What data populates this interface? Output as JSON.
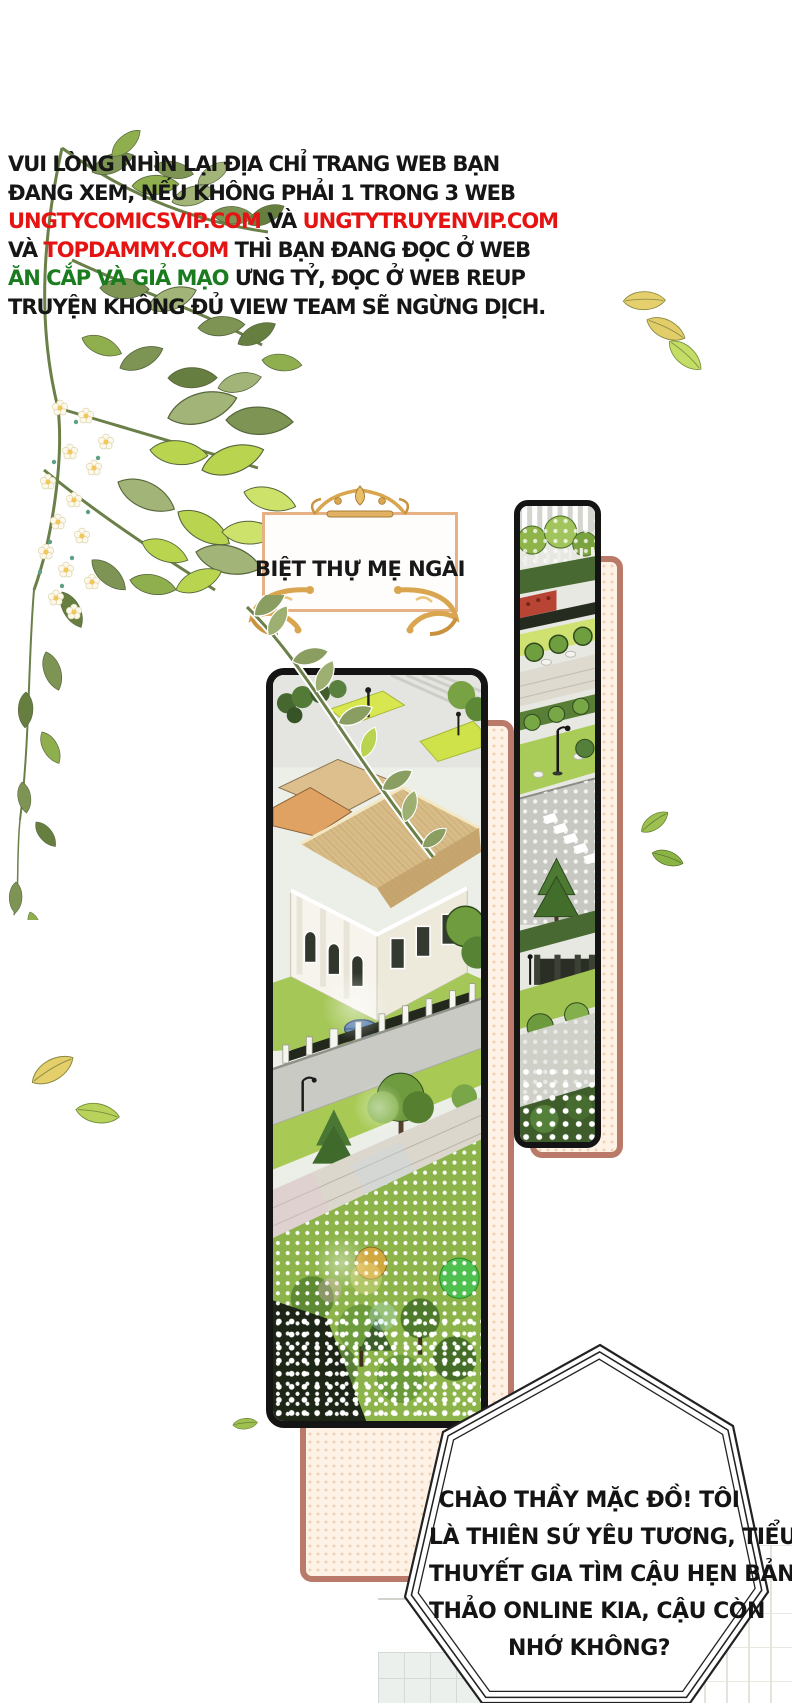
{
  "page": {
    "width": 792,
    "height": 1703,
    "background": "#ffffff",
    "kind": "comic-page"
  },
  "warning": {
    "line1": "VUI LÒNG NHÌN LẠI ĐỊA CHỈ TRANG WEB BẠN",
    "line2": "ĐANG XEM, NẾU KHÔNG PHẢI 1 TRONG 3 WEB",
    "line3_url1": "UNGTYCOMICSVIP.COM",
    "line3_mid": " VÀ ",
    "line3_url2": "UNGTYTRUYENVIP.COM",
    "line4_pre": "VÀ ",
    "line4_url3": "TOPDAMMY.COM",
    "line4_post": " THÌ BẠN ĐANG ĐỌC Ở WEB",
    "line5_green": "ĂN CẮP VÀ GIẢ MẠO",
    "line5_post": " ƯNG TỶ, ĐỌC Ở WEB REUP",
    "line6": "TRUYỆN KHÔNG ĐỦ VIEW TEAM SẼ NGỪNG DỊCH."
  },
  "title_card": {
    "label": "BIỆT THỰ MẸ NGÀI"
  },
  "speech_bubble": {
    "line1": "CHÀO THẦY MẶC ĐỒ! TÔI",
    "line2": "LÀ THIÊN SỨ YÊU TƯƠNG, TIỂU",
    "line3": "THUYẾT GIA TÌM CẬU HẸN BẢN",
    "line4": "THẢO ONLINE KIA, CẬU CÒN",
    "line5": "NHỚ KHÔNG?"
  },
  "colors": {
    "text_black": "#161616",
    "url_red": "#e61313",
    "warning_green": "#1a7c1e",
    "ornament_gold": "#d9a64f",
    "card_border": "#e7b186",
    "backdrop_border": "#ba7a6a",
    "backdrop_fill": "#fdf2e5",
    "panel_border": "#141414",
    "bubble_outline": "#222222",
    "grass_green": "#a5c757",
    "roof_tan": "#d8bc88"
  },
  "decor_icons": [
    "flower-vine-cluster",
    "vine-branch-overlay",
    "falling-leaf",
    "crown-ornament",
    "corner-flourish",
    "halftone-dots"
  ]
}
